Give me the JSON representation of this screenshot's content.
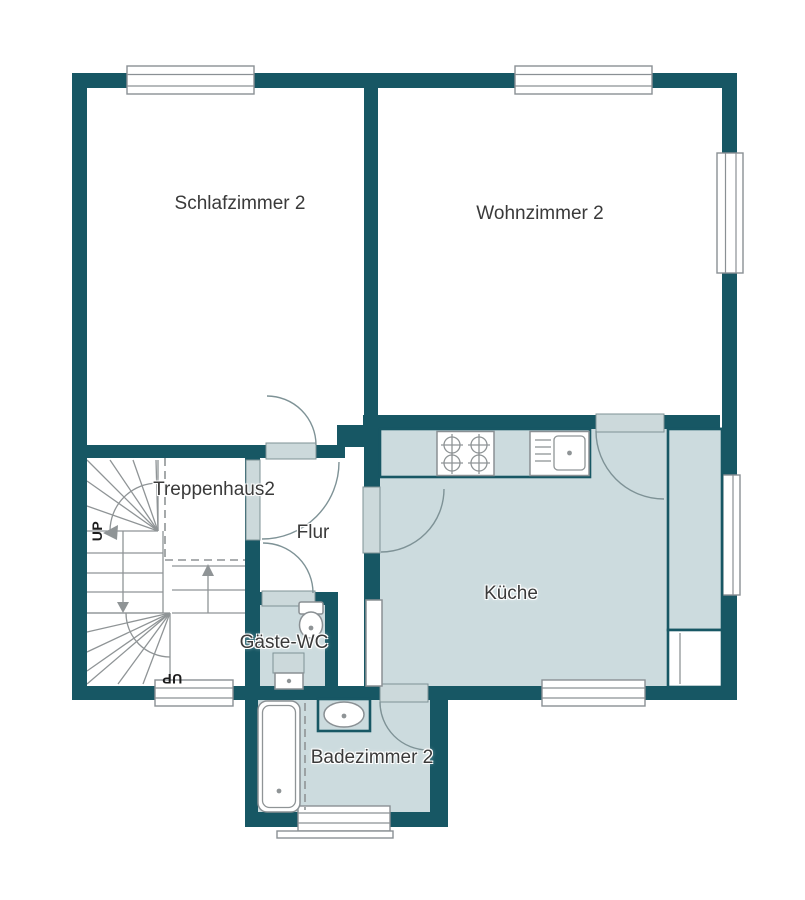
{
  "meta": {
    "type": "apartment-floor-plan",
    "floor_note": "upper floor with stairwell"
  },
  "colors": {
    "wall": "#175764",
    "wet_floor": "#ccdbde",
    "door_leaf": "#ccd9db",
    "outline": "#7e9296",
    "window_line": "#8a9094",
    "stair_line": "#8f9496",
    "label_text": "#3a3a3a"
  },
  "rooms": {
    "schlafzimmer": {
      "label": "Schlafzimmer 2"
    },
    "wohnzimmer": {
      "label": "Wohnzimmer 2"
    },
    "treppenhaus": {
      "label": "Treppenhaus2"
    },
    "flur": {
      "label": "Flur"
    },
    "kueche": {
      "label": "Küche"
    },
    "gaeste_wc": {
      "label": "Gäste-WC"
    },
    "badezimmer": {
      "label": "Badezimmer 2"
    }
  },
  "stairs": {
    "up_label_top": "UP",
    "up_label_bottom": "UP"
  }
}
